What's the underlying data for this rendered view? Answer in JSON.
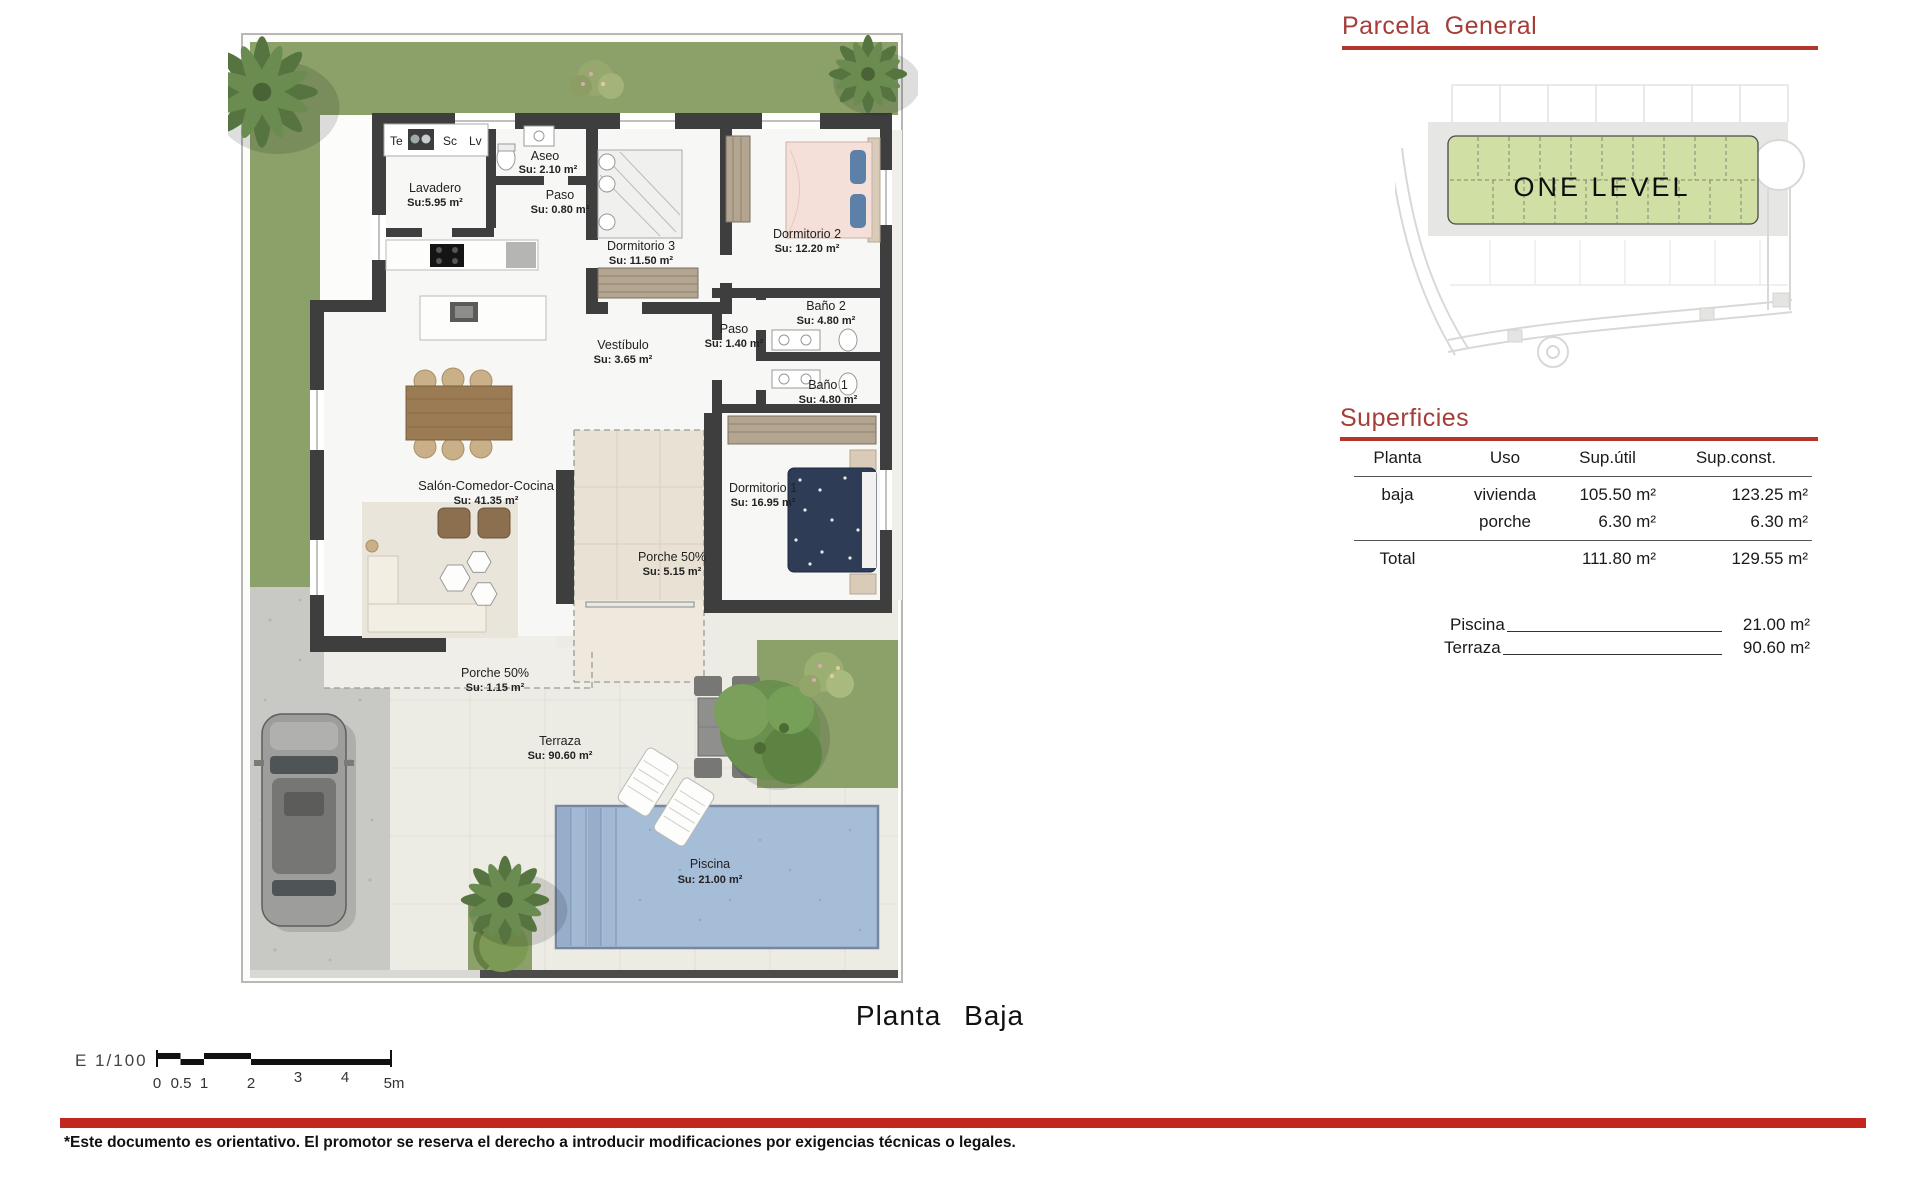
{
  "plan": {
    "title": "Planta Baja",
    "legend": [
      "Te",
      "Sc",
      "Lv"
    ],
    "rooms": [
      {
        "name": "Lavadero",
        "area": "Su:5.95 m²"
      },
      {
        "name": "Aseo",
        "area": "Su: 2.10 m²"
      },
      {
        "name": "Paso",
        "area": "Su: 0.80 m²"
      },
      {
        "name": "Dormitorio 3",
        "area": "Su: 11.50 m²"
      },
      {
        "name": "Dormitorio 2",
        "area": "Su: 12.20 m²"
      },
      {
        "name": "Baño 2",
        "area": "Su: 4.80 m²"
      },
      {
        "name": "Paso",
        "area": "Su: 1.40 m²"
      },
      {
        "name": "Baño 1",
        "area": "Su: 4.80 m²"
      },
      {
        "name": "Vestíbulo",
        "area": "Su: 3.65 m²"
      },
      {
        "name": "Dormitorio 1",
        "area": "Su: 16.95 m²"
      },
      {
        "name": "Salón-Comedor-Cocina",
        "area": "Su: 41.35 m²"
      },
      {
        "name": "Porche 50%",
        "area": "Su: 5.15 m²"
      },
      {
        "name": "Porche 50%",
        "area": "Su: 1.15 m²"
      },
      {
        "name": "Terraza",
        "area": "Su: 90.60 m²"
      },
      {
        "name": "Piscina",
        "area": "Su: 21.00 m²"
      }
    ]
  },
  "parcela": {
    "title": "Parcela General",
    "plot_label": "ONE LEVEL"
  },
  "superficies": {
    "title": "Superficies",
    "headers": [
      "Planta",
      "Uso",
      "Sup.útil",
      "Sup.const."
    ],
    "rows": [
      {
        "planta": "baja",
        "uso": "vivienda",
        "sup_util": "105.50 m²",
        "sup_const": "123.25 m²"
      },
      {
        "planta": "",
        "uso": "porche",
        "sup_util": "6.30 m²",
        "sup_const": "6.30 m²"
      }
    ],
    "total": {
      "label": "Total",
      "sup_util": "111.80 m²",
      "sup_const": "129.55 m²"
    },
    "extras": [
      {
        "label": "Piscina",
        "value": "21.00 m²"
      },
      {
        "label": "Terraza",
        "value": "90.60 m²"
      }
    ]
  },
  "scale": {
    "label": "E 1/100",
    "ticks": [
      "0",
      "0.5",
      "1",
      "2",
      "3",
      "4",
      "5m"
    ]
  },
  "disclaimer": "*Este documento es orientativo. El promotor se reserva el derecho a introducir modificaciones por exigencias técnicas o legales.",
  "colors": {
    "accent_red": "#a53d38",
    "rule_red": "#b5352c",
    "footer_red": "#c1271d",
    "lawn_green": "#8ba169",
    "parcel_green": "#d0e0a5",
    "pool_blue": "#a6bdd8",
    "wall_gray": "#3e3e3e"
  }
}
